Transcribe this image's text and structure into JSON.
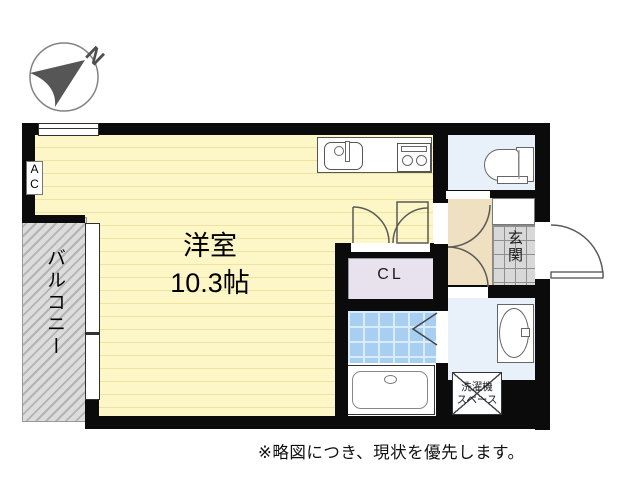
{
  "compass": {
    "label": "N"
  },
  "rooms": {
    "main": {
      "name": "洋室",
      "size": "10.3帖"
    },
    "balcony": {
      "name": "バルコニー"
    },
    "closet": {
      "name": "CL"
    },
    "entrance": {
      "name": "玄関"
    },
    "laundry": {
      "line1": "洗濯機",
      "line2": "スペース"
    },
    "ac": {
      "line1": "A",
      "line2": "C"
    }
  },
  "note": {
    "text": "※略図につき、現状を優先します。"
  },
  "colors": {
    "wall": "#0b0b0b",
    "room_floor": "#fdf6c6",
    "room_stripe": "#efe3a4",
    "balcony": "#d9d9d9",
    "closet": "#e8e2ee",
    "bath_tile": "#a8cff2",
    "water_floor": "#e8f1fa",
    "hallway": "#eee0c0",
    "genkan_tile": "#d8d8d8"
  }
}
